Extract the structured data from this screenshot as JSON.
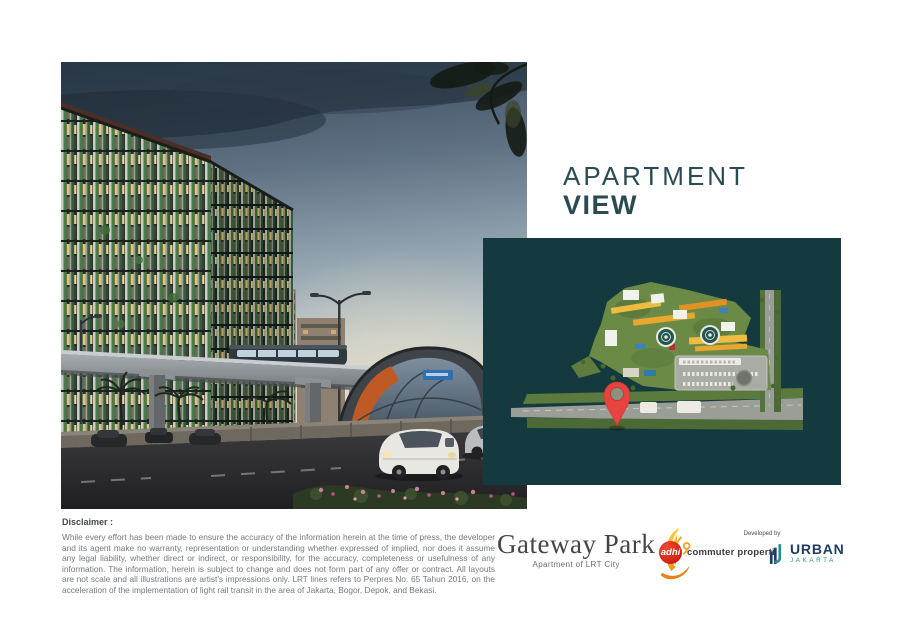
{
  "title": {
    "line1": "APARTMENT",
    "line2": "VIEW"
  },
  "disclaimer": {
    "heading": "Disclaimer :",
    "body": "While every effort has been made to ensure the accuracy of the information herein at the time of press, the developer and its agent make no warranty, representation or understanding whether expressed of implied, nor does it assume any legal liability, whether direct or indirect, or responsibility, for the accuracy, completeness or usefulness of any information. The information, herein is subject to change and does not form part of any offer or contract. All layouts are not scale and all illustrations are artist's impressions only. LRT lines refers to Perpres No. 65 Tahun 2016, on the acceleration of the implementation of light rail transit in the area of Jakarta, Bogor, Depok, and Bekasi."
  },
  "logos": {
    "gateway_park": {
      "wordmark": "Gateway Park",
      "tagline": "Apartment of LRT City",
      "bird_icon": "yellow-swoosh-bird"
    },
    "adhi": {
      "mark_text": "adhi",
      "label": "commuter properti",
      "mark_color": "#d32315"
    },
    "developer": {
      "prefix": "Developed by",
      "name": "URBAN",
      "sub": "JAKARTA",
      "name_color": "#1e3c64",
      "sub_color": "#2e8a96"
    }
  },
  "map_panel": {
    "background_color": "#143a3f",
    "marker_icon": "location-pin",
    "marker_color": "#e8433f"
  },
  "hero_photo": {
    "subject_icons": [
      "apartment-building",
      "lrt-elevated-track",
      "lrt-station",
      "cars-on-road"
    ]
  },
  "colors": {
    "title_teal": "#2a4b52"
  }
}
